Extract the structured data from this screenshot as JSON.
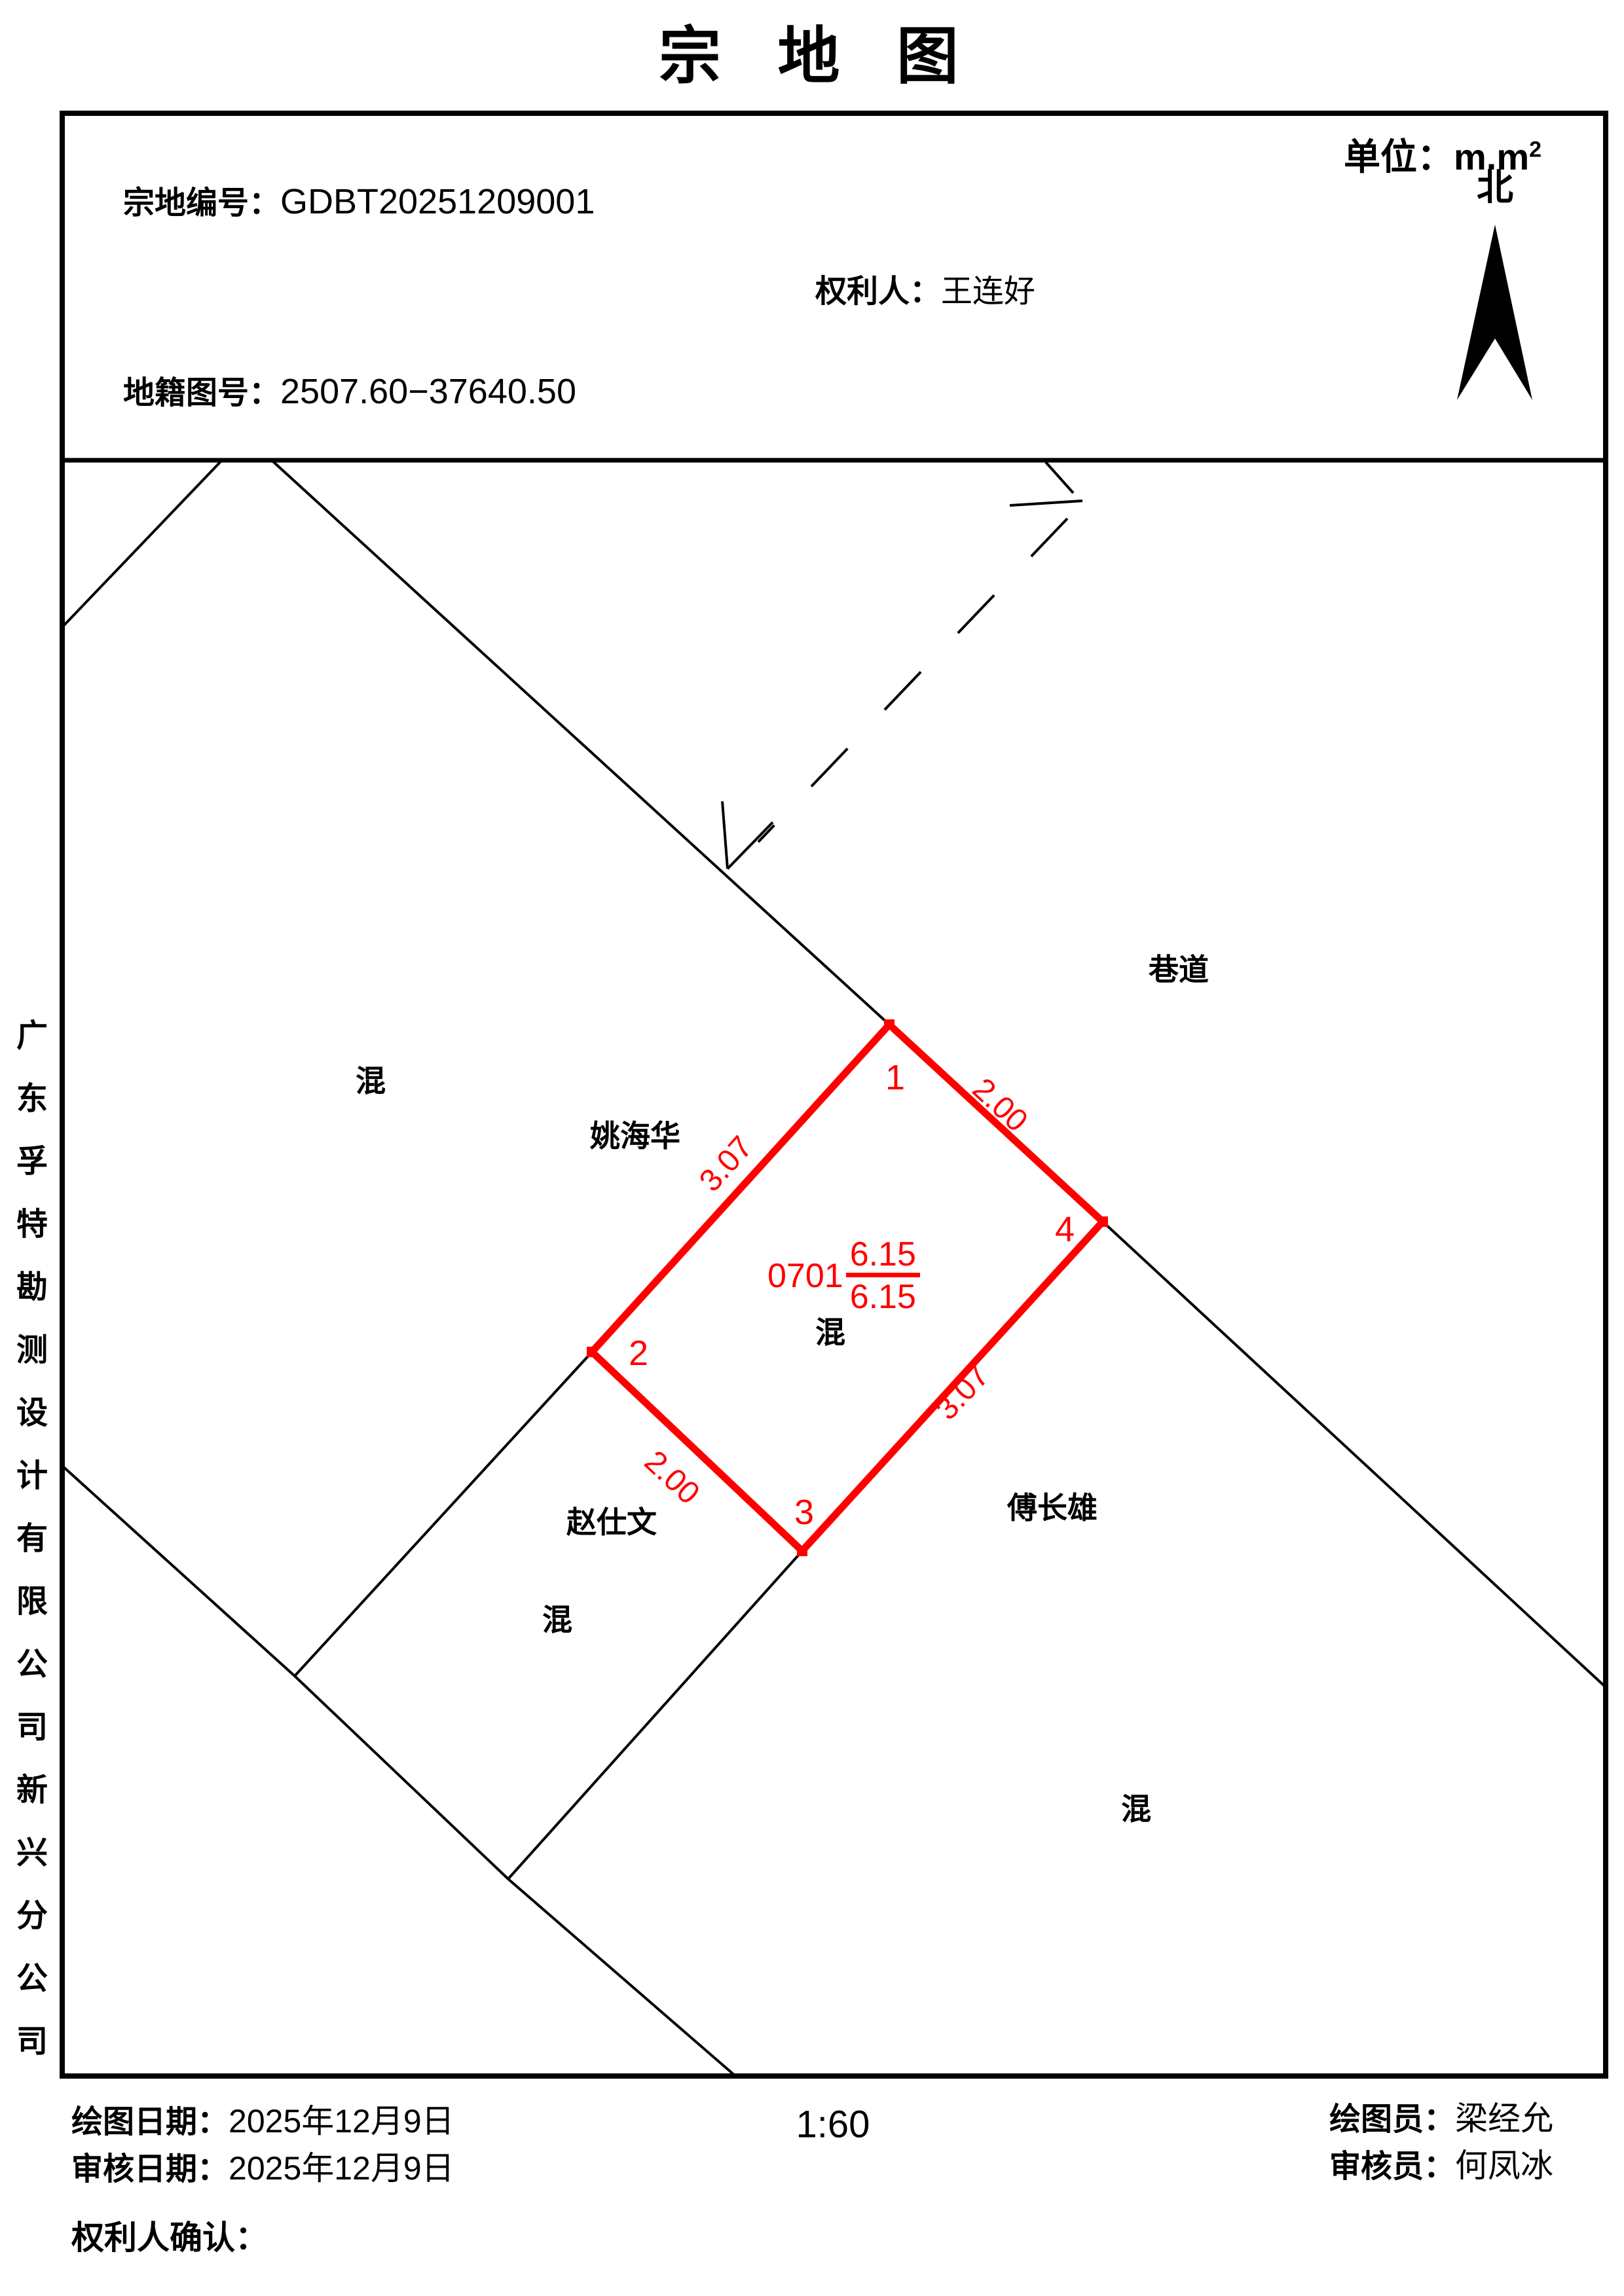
{
  "page": {
    "title": "宗 地 图",
    "unit_label": "单位：m.m",
    "unit_sup": "2"
  },
  "header": {
    "parcel_no_label": "宗地编号：",
    "parcel_no": "GDBT20251209001",
    "owner_label": "权利人：",
    "owner": "王连好",
    "sheet_no_label": "地籍图号：",
    "sheet_no": "2507.60−37640.50",
    "north_label": "北"
  },
  "map": {
    "road_label": "巷道",
    "neighbors": [
      "姚海华",
      "赵仕文",
      "傅长雄"
    ],
    "mix_labels": [
      "混",
      "混",
      "混",
      "混"
    ],
    "parcel": {
      "code": "0701",
      "area_numerator": "6.15",
      "area_denominator": "6.15",
      "land_use": "混",
      "vertex_labels": {
        "v1": "1",
        "v2": "2",
        "v3": "3",
        "v4": "4"
      },
      "edge_lengths": {
        "e14": "2.00",
        "e12": "3.07",
        "e43": "3.07",
        "e23": "2.00"
      }
    },
    "colors": {
      "parcel_stroke": "#ff0000",
      "line": "#000000"
    }
  },
  "sidebar": {
    "company": "广东孚特勘测设计有限公司新兴分公司"
  },
  "footer": {
    "draw_date_label": "绘图日期：",
    "draw_date": "2025年12月9日",
    "review_date_label": "审核日期：",
    "review_date": "2025年12月9日",
    "scale": "1:60",
    "drafter_label": "绘图员：",
    "drafter": "梁经允",
    "reviewer_label": "审核员：",
    "reviewer": "何凤冰",
    "owner_confirm_label": "权利人确认："
  }
}
